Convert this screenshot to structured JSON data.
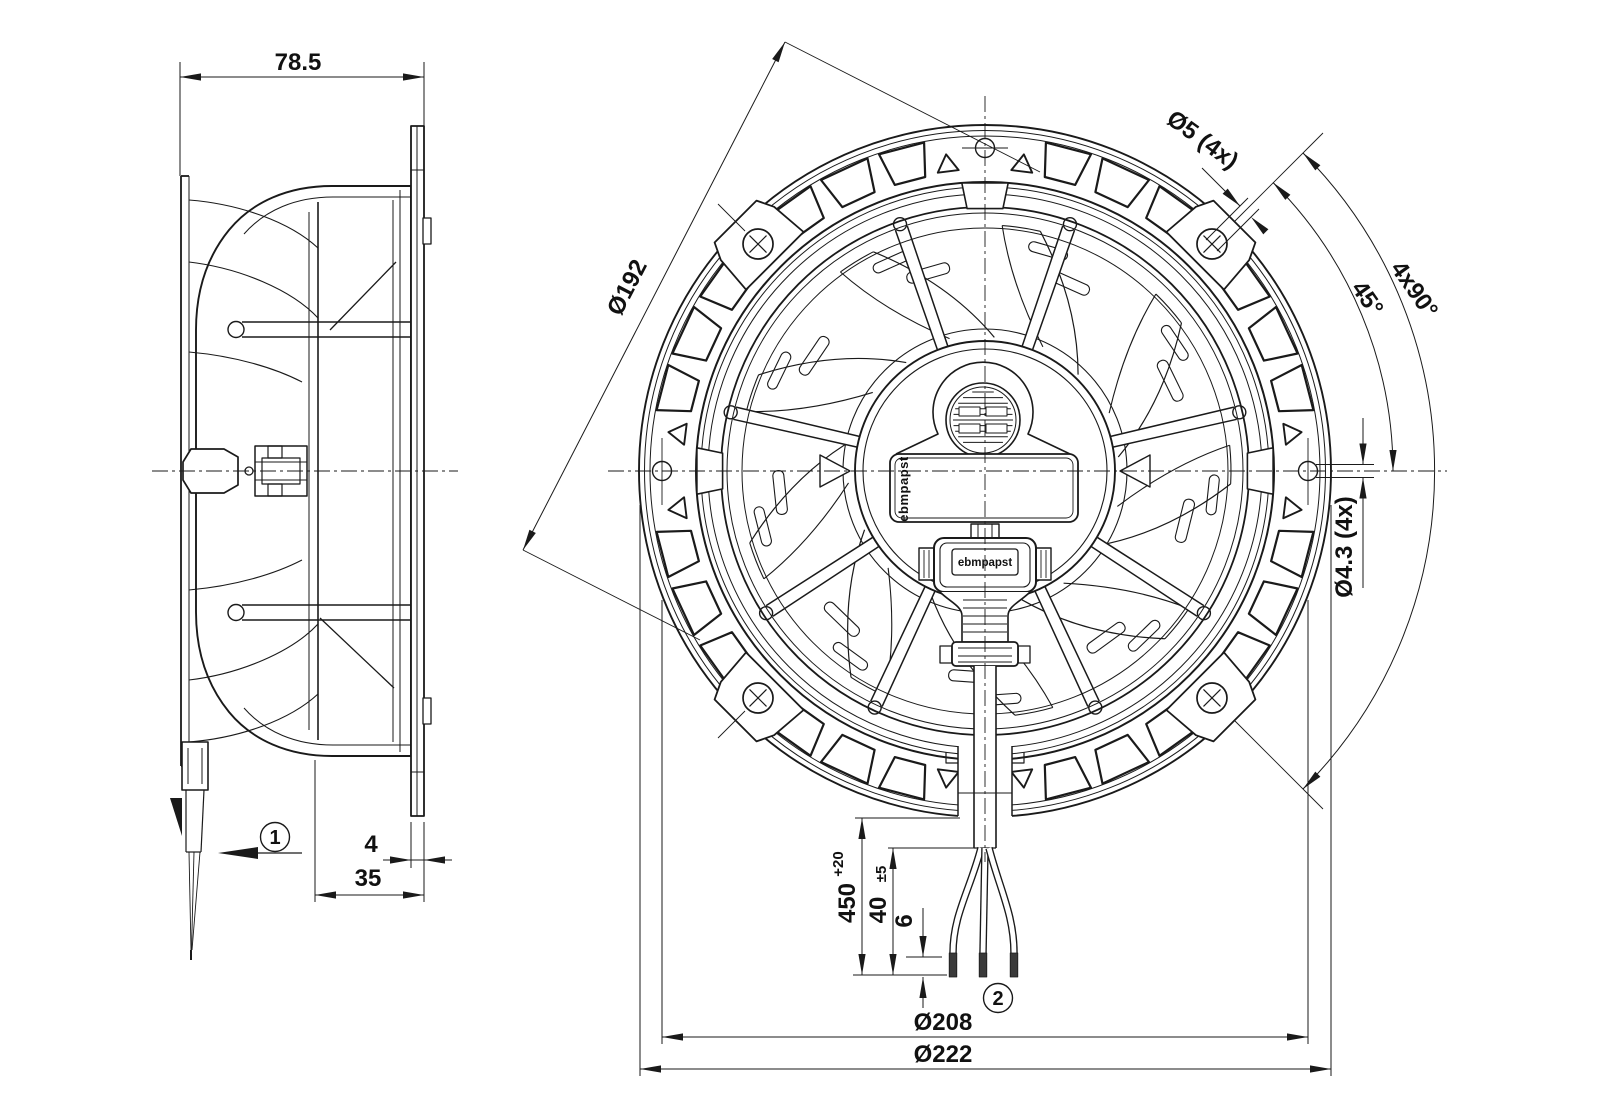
{
  "drawing": {
    "brand": "ebmpapst",
    "logos": {
      "impeller_label": "ebmpapst",
      "connector_label": "ebmpapst"
    },
    "callouts": {
      "airflow_direction": "1",
      "lead_wires": "2"
    },
    "dimensions": {
      "depth_total": "78.5",
      "flange_thickness": "4",
      "housing_depth": "35",
      "inlet_diameter": "Ø192",
      "mounting_hole_diameter": "Ø5 (4x)",
      "mounting_hole_pattern": "4x90°",
      "mounting_hole_angle": "45°",
      "flange_hole_diameter": "Ø4.3 (4x)",
      "cable_length": "450",
      "cable_length_tolerance": "+20",
      "wire_free_length": "40",
      "wire_free_length_tolerance": "±5",
      "strip_length": "6",
      "pitch_circle_diameter": "Ø208",
      "outer_diameter": "Ø222"
    },
    "colors": {
      "line": "#1a1a1a",
      "background": "#ffffff"
    }
  }
}
